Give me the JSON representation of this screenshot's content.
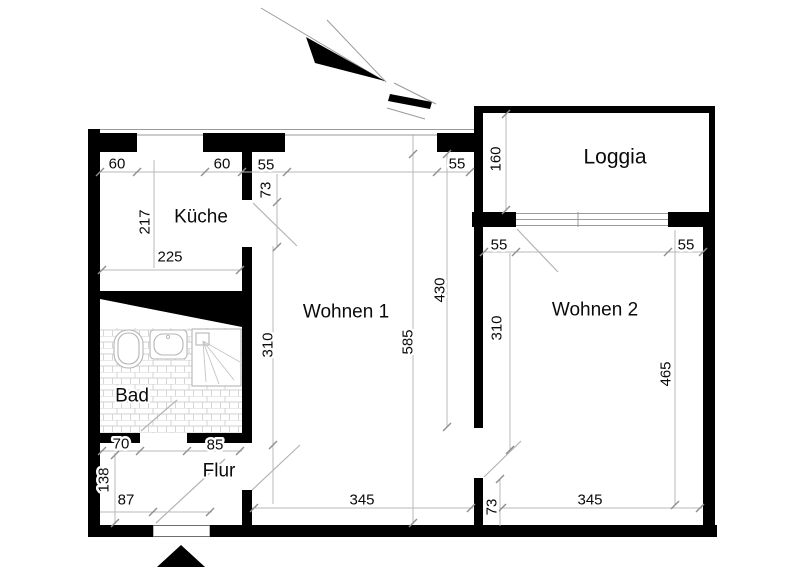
{
  "rooms": {
    "kueche": "Küche",
    "bad": "Bad",
    "flur": "Flur",
    "wohnen1": "Wohnen 1",
    "wohnen2": "Wohnen 2",
    "loggia": "Loggia"
  },
  "dims": {
    "top_pier_left": "60",
    "top_pier_mid": "60",
    "w1_top_left": "55",
    "w1_door": "73",
    "w1_top_right": "55",
    "loggia_depth": "160",
    "kueche_depth": "217",
    "kueche_width": "225",
    "w1_left": "310",
    "w1_height": "585",
    "w1_right": "430",
    "w2_top_left": "55",
    "w2_top_right": "55",
    "w2_left": "310",
    "w2_right": "465",
    "bad_door": "70",
    "bad_pier": "85",
    "flur_left": "138",
    "entrance_width": "87",
    "w1_bottom": "345",
    "w2_door": "73",
    "w2_bottom": "345"
  },
  "colors": {
    "wall": "#000000",
    "dim_line": "#b8b8b8",
    "text": "#0a0a0a"
  }
}
